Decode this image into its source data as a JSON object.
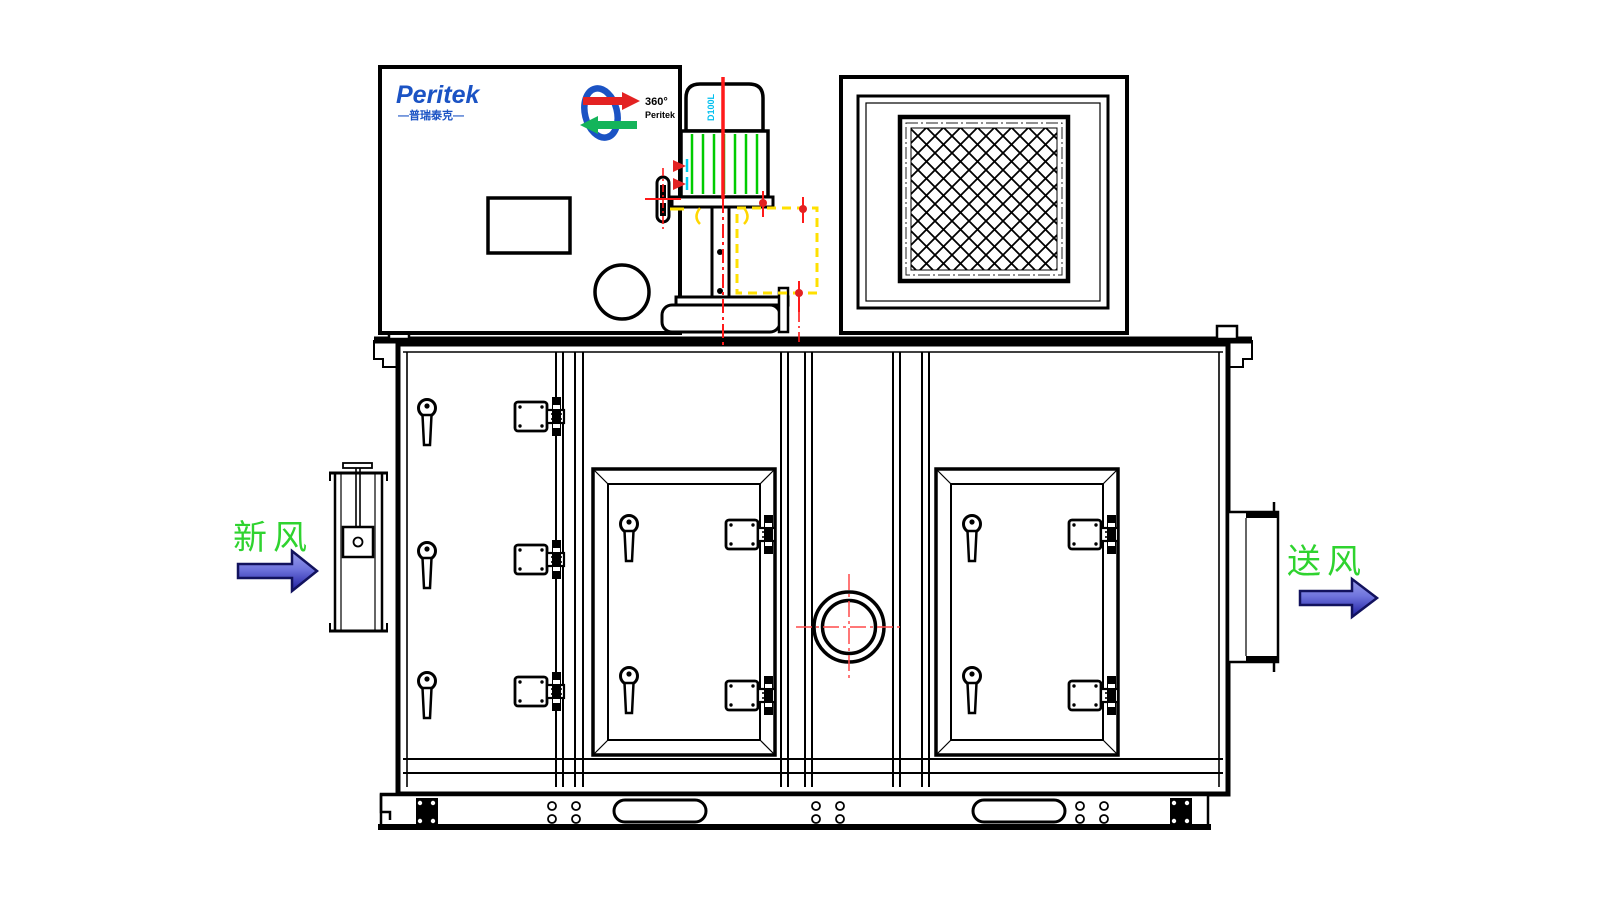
{
  "title": "Peritek desiccant dehumidifier unit - front elevation drawing",
  "brand": {
    "logo_text": "Peritek",
    "logo_subtext": "—普瑞泰克—",
    "rotor_logo_degree": "360°",
    "rotor_logo_name": "Peritek",
    "logo_color": "#1b53c4"
  },
  "motor": {
    "model_label": "D100L",
    "label_color": "#00bfef",
    "fin_color": "#00cc00",
    "centerline_color": "#ff1a1a"
  },
  "annotations": {
    "fresh_air_label": "新风",
    "supply_air_label": "送风",
    "label_color": "#2fd32f",
    "arrow_outline_color": "#12125e",
    "arrow_fill_top": "#9a9eec",
    "arrow_fill_bottom": "#1d1d9e"
  },
  "drawing": {
    "line_color": "#000000",
    "background": "#ffffff",
    "highlight_yellow": "#ffe000",
    "highlight_red": "#ff1a1a",
    "highlight_cyan": "#00cfef",
    "crosshair_red": "#ff4a4a"
  }
}
